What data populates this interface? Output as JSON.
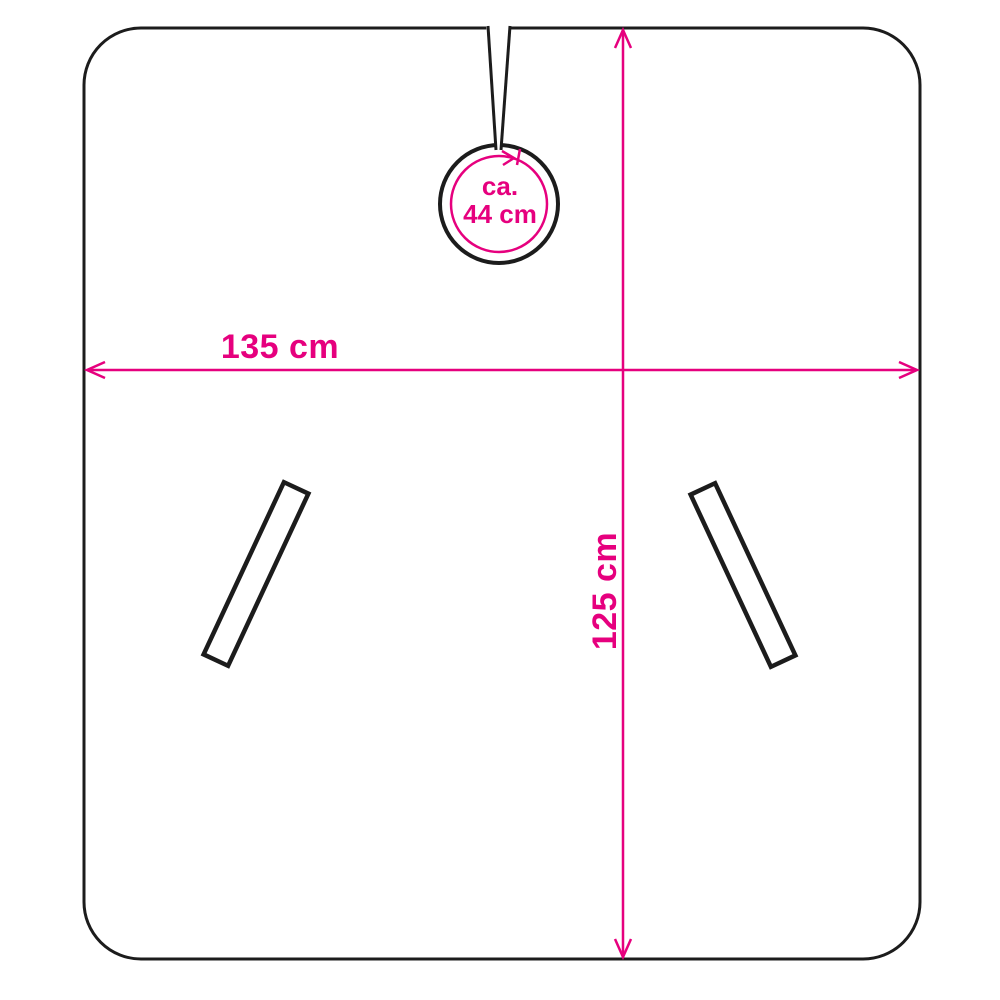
{
  "diagram": {
    "type": "product-dimension-drawing",
    "subject": "hairdressing cape with neck opening and two slanted slits",
    "labels": {
      "width": "135 cm",
      "height": "125 cm",
      "neck_prefix": "ca.",
      "neck_value": "44 cm"
    },
    "measurements": {
      "width_cm": 135,
      "height_cm": 125,
      "neck_circumference_cm_approx": 44
    }
  },
  "colors": {
    "accent": "#e6007e",
    "outline": "#1c1c1c",
    "bg": "#ffffff"
  }
}
